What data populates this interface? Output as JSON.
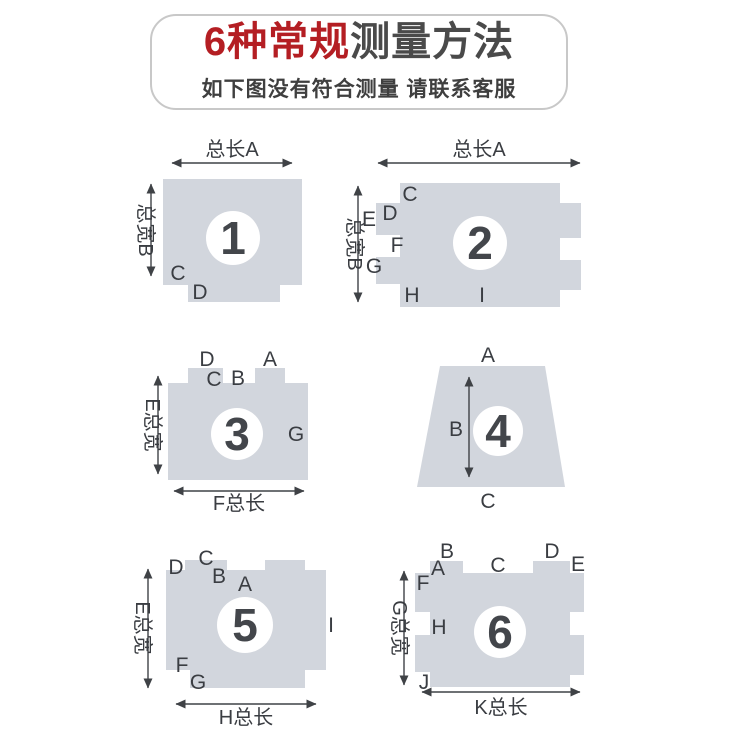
{
  "header": {
    "title_red": "6种常规",
    "title_dark": "测量方法",
    "subtitle": "如下图没有符合测量 请联系客服"
  },
  "colors": {
    "shape_fill": "#d2d6dd",
    "accent_red": "#b41e23",
    "title_dark": "#4a4a4a",
    "label_color": "#3a3d42",
    "header_border": "#c8c8c8"
  },
  "diagrams": [
    {
      "num": "1",
      "dim_top": "总长A",
      "dim_left": "总宽B",
      "labels": [
        "C",
        "D"
      ]
    },
    {
      "num": "2",
      "dim_top": "总长A",
      "dim_left": "总宽B",
      "labels": [
        "C",
        "D",
        "E",
        "F",
        "G",
        "H",
        "I"
      ]
    },
    {
      "num": "3",
      "dim_left": "E总宽",
      "dim_bottom": "F总长",
      "labels": [
        "D",
        "A",
        "C",
        "B",
        "G"
      ]
    },
    {
      "num": "4",
      "labels": [
        "A",
        "B",
        "C"
      ]
    },
    {
      "num": "5",
      "dim_left": "E总宽",
      "dim_bottom": "H总长",
      "labels": [
        "D",
        "C",
        "B",
        "A",
        "F",
        "G",
        "I"
      ]
    },
    {
      "num": "6",
      "dim_left": "G总宽",
      "dim_bottom": "K总长",
      "labels": [
        "B",
        "A",
        "F",
        "C",
        "D",
        "E",
        "H",
        "J"
      ]
    }
  ]
}
